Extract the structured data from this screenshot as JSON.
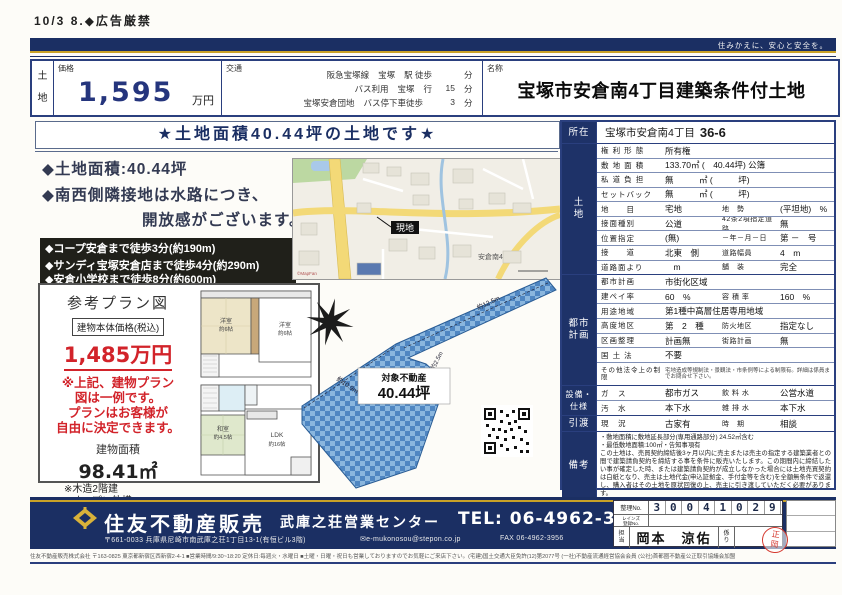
{
  "page": {
    "corner_note": "10/3 8.◆広告厳禁",
    "tagline": "住みかえに、安心と安全を。"
  },
  "header": {
    "category": "土\n地",
    "price_label": "価格",
    "price_value": "1,595",
    "price_unit": "万円",
    "access_label": "交通",
    "access_rows": [
      {
        "c1": "阪急宝塚線",
        "c2": "宝塚",
        "c3": "駅 徒歩",
        "c4": "",
        "c5": "分"
      },
      {
        "c1": "バス利用",
        "c2": "宝塚",
        "c3": "行",
        "c4": "15",
        "c5": "分"
      },
      {
        "c1": "宝塚安倉団地",
        "c2": "バス停下車徒歩",
        "c3": "",
        "c4": "3",
        "c5": "分"
      }
    ],
    "name_label": "名称",
    "name_value": "宝塚市安倉南4丁目建築条件付土地"
  },
  "main": {
    "banner": "★土地面積40.44坪の土地です★",
    "feature_1": "◆土地面積:40.44坪",
    "feature_2": "◆南西側隣接地は水路につき、",
    "feature_3": "開放感がございます。",
    "highlight_1": "◆コープ安倉まで徒歩3分(約190m)",
    "highlight_2": "◆サンディ宝塚安倉店まで徒歩4分(約290m)",
    "highlight_3": "◆安倉小学校まで徒歩8分(約600m)",
    "plan_box": {
      "title": "参考プラン図",
      "price_label": "建物本体価格(税込)",
      "price": "1,485万円",
      "note": "※上記、建物プラン\n図は一例です。\nプランはお客様が\n自由に決定できます。",
      "area_label": "建物面積",
      "area": "98.41㎡",
      "sub_1": "※木造2階建",
      "sub_2": "※オープン外構"
    },
    "map": {
      "site_label": "現地",
      "district_label": "安倉南4",
      "credit": "©MapFan"
    },
    "floorplan": {
      "f2_rooms": [
        {
          "n": "洋室",
          "s": "約6帖"
        },
        {
          "n": "洋室",
          "s": "約6帖"
        }
      ],
      "f1_rooms": [
        {
          "n": "和室",
          "s": "約4.5帖"
        },
        {
          "n": "LDK",
          "s": "約16帖"
        }
      ]
    },
    "siteplan": {
      "label": "対象不動産",
      "area": "40.44坪",
      "dim_arm": "約12.5m",
      "dim_side": "約2.5m",
      "dim_left": "約10.9m"
    }
  },
  "details": {
    "location_label": "所在",
    "land_label": "土\n地",
    "city_label": "都市\n計画",
    "equip_label": "設備・\n仕様",
    "handover_label": "引渡",
    "remarks_label": "備考",
    "location": {
      "city": "宝塚市安倉南4丁目",
      "lot": "36-6"
    },
    "land_rows": [
      {
        "k": "権 利 形 態",
        "v": "所有権",
        "k2": "",
        "v2": ""
      },
      {
        "k": "敷 地 面 積",
        "v": "133.70㎡ (　40.44坪) 公簿",
        "k2": "",
        "v2": ""
      },
      {
        "k": "私 道 負 担",
        "v": "無　　　㎡ (　　　坪)",
        "k2": "",
        "v2": ""
      },
      {
        "k": "セットバック",
        "v": "無　　　㎡ (　　　坪)",
        "k2": "",
        "v2": ""
      },
      {
        "k": "地　　目",
        "v": "宅地",
        "k2": "地　勢",
        "v2": "(平坦地)　%"
      },
      {
        "k": "接面種別",
        "v": "公道",
        "k2": "42条2項指定道路",
        "v2": "無"
      },
      {
        "k": "位置指定",
        "v": "(無)",
        "k2": "－年－月－日",
        "v2": "第 －　号"
      },
      {
        "k": "接　　道",
        "v": "北東　側",
        "k2": "道路幅員",
        "v2": "4　m"
      },
      {
        "k": "道路面より",
        "v": "　m",
        "k2": "舗　装",
        "v2": "完全"
      }
    ],
    "city_rows": [
      {
        "k": "都市計画",
        "v": "市街化区域",
        "k2": "",
        "v2": ""
      },
      {
        "k": "建ペイ率",
        "v": "60　%",
        "k2": "容 積 率",
        "v2": "160　%"
      },
      {
        "k": "用途地域",
        "v": "第1種中高層住居専用地域",
        "k2": "",
        "v2": ""
      },
      {
        "k": "高度地区",
        "v": "第　2　種",
        "k2": "防火地区",
        "v2": "指定なし"
      },
      {
        "k": "区画整理",
        "v": "計画無",
        "k2": "街路計画",
        "v2": "無"
      },
      {
        "k": "国 土 法",
        "v": "不要",
        "k2": "",
        "v2": ""
      }
    ],
    "restrictions_k": "その他法令上の制限",
    "restrictions_v": "宅地造成等規制法・景観法・市条例等による制限有。詳細は係員までお問合せ下さい。",
    "equip_rows": [
      {
        "k": "ガ　ス",
        "v": "都市ガス",
        "k2": "飲 料 水",
        "v2": "公営水道"
      },
      {
        "k": "汚　水",
        "v": "本下水",
        "k2": "雑 排 水",
        "v2": "本下水"
      }
    ],
    "handover": {
      "k": "現　況",
      "v": "古家有",
      "k2": "時　期",
      "v2": "相談"
    },
    "remarks_1": "・敷地面積に敷地延長部分(専用通路部分) 24.52㎡含む",
    "remarks_2": "・最低敷地面積:100㎡・告知事項有",
    "remarks_3": "この土地は、売買契約締結後3ヶ月以内に売主または売主の指定する建築業者との間で建築請負契約を締結する事を条件に販売いたします。この期間内に締結したい事が確定した時、または建築請負契約が成立しなかった場合には土地売買契約は白紙となり、売主は土地代金(申込証拠金、手付金等を含む)を全額無条件で返還し、購入者はその土地を原状回復の上、売主に引き渡していただく必要があります。"
  },
  "footer": {
    "company": "住友不動産販売",
    "office": "武庫之荘営業センター",
    "tel": "TEL: 06-4962-3955",
    "address": "〒661-0033 兵庫県尼崎市南武庫之荘1丁目13-1(有恒ビル3階)",
    "email": "✉e-mukonosou@stepon.co.jp",
    "fax": "FAX 06-4962-3956",
    "reg_label": "整理No.",
    "digits": [
      "3",
      "0",
      "0",
      "4",
      "1",
      "0",
      "2",
      "9"
    ],
    "reins_label": "レインズ\n登録No.",
    "staff_label": "担\n当",
    "staff_name": "岡本　涼佑",
    "check_label": "係\nり",
    "stamp": "正\n岡",
    "fine_print": "住友不動産販売株式会社 〒163-0825 東京都新宿区西新宿2-4-1 ■営業時間/9:30~18:20 定休日:毎週火・水曜日 ■土曜・日曜・祝日も営業しておりますのでお気軽にご来店下さい。(宅建)国土交通大臣免許(12)第2077号 (一社)不動産流通経営協会会員 (公社)首都圏不動産公正取引協議会加盟"
  }
}
